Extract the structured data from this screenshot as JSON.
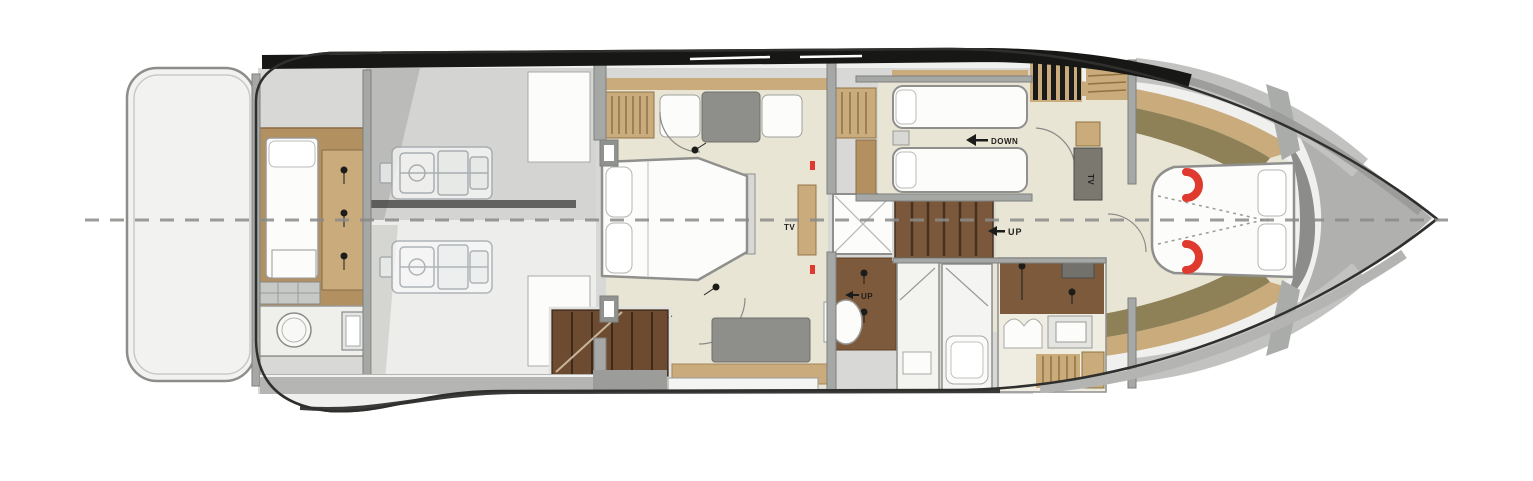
{
  "diagram": {
    "type": "yacht-lower-deck-floor-plan",
    "labels": {
      "master_tv": "TV",
      "guest_tv": "TV",
      "corridor_up": "UP",
      "aft_up": "UP",
      "guest_down": "DOWN"
    },
    "icons": {
      "down_arrow": "left-arrow",
      "up_arrow": "left-arrow",
      "door_swing": "quarter-arc",
      "centerline": "dashed-line"
    },
    "colors": {
      "hull_outline": "#2f2f2d",
      "hull_fill": "#f0f0ee",
      "deck_gray": "#d8d8d6",
      "band_black": "#171715",
      "band_gray": "#b4b4b2",
      "wall_gray": "#a5a8a5",
      "floor_beige": "#e9e5d4",
      "wood": "#b3905f",
      "wood_dark": "#7d5a3c",
      "stair_brown": "#6d4b31",
      "tan": "#c9ab7c",
      "olive": "#8f8157",
      "furniture_white": "#fcfcfa",
      "bench_gray": "#8e8e8a",
      "accent_red": "#e0392e",
      "centerline_gray": "#8b8b89",
      "engine_line": "#9aa1a7"
    }
  }
}
